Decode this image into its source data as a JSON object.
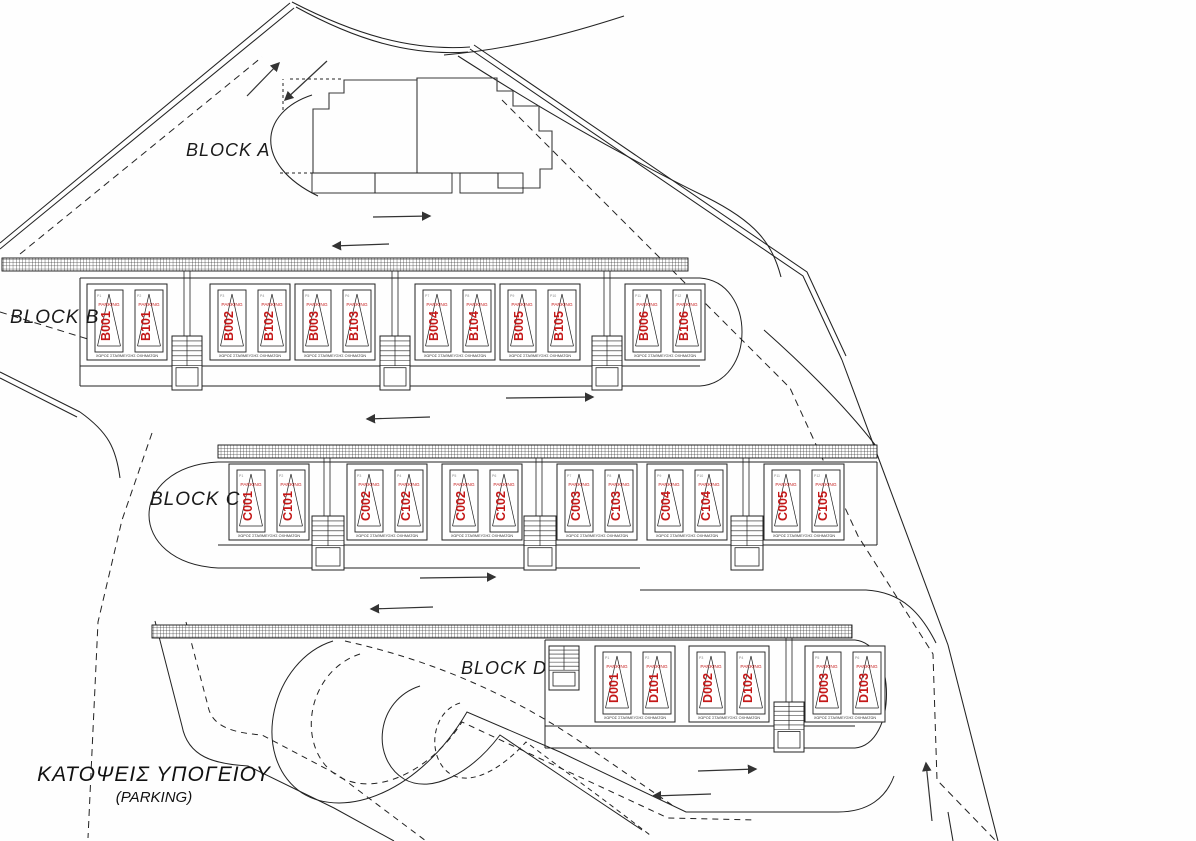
{
  "drawing": {
    "title_line1": "ΚΑΤΟΨΕΙΣ ΥΠΟΓΕΙΟΥ",
    "title_line2": "(PARKING)",
    "stall_caption": "ΧΩΡΟΣ ΣΤΑΘΜΕΥΣΗΣ ΟΧΗΜΑΤΩΝ",
    "parking_word": "PARKING",
    "colors": {
      "red": "#c41818",
      "line": "#222222"
    },
    "blocks": {
      "a": {
        "label": "BLOCK A"
      },
      "b": {
        "label": "BLOCK B",
        "stalls": [
          "B001",
          "B101",
          "B002",
          "B102",
          "B003",
          "B103",
          "B004",
          "B104",
          "B005",
          "B105",
          "B006",
          "B106"
        ],
        "ptags": [
          "P1",
          "P2",
          "P3",
          "P4",
          "P5",
          "P6",
          "P7",
          "P8",
          "P9",
          "P10",
          "P11",
          "P12"
        ]
      },
      "c": {
        "label": "BLOCK C",
        "stalls": [
          "C001",
          "C101",
          "C002",
          "C102",
          "C002",
          "C102",
          "C003",
          "C103",
          "C004",
          "C104",
          "C005",
          "C105"
        ],
        "ptags": [
          "P1",
          "P2",
          "P3",
          "P4",
          "P5",
          "P6",
          "P7",
          "P8",
          "P9",
          "P10",
          "P11",
          "P12"
        ]
      },
      "d": {
        "label": "BLOCK D",
        "stalls": [
          "D001",
          "D101",
          "D002",
          "D102",
          "D003",
          "D103"
        ],
        "ptags": [
          "P1",
          "P2",
          "P3",
          "P4",
          "P5",
          "P6"
        ]
      }
    }
  }
}
